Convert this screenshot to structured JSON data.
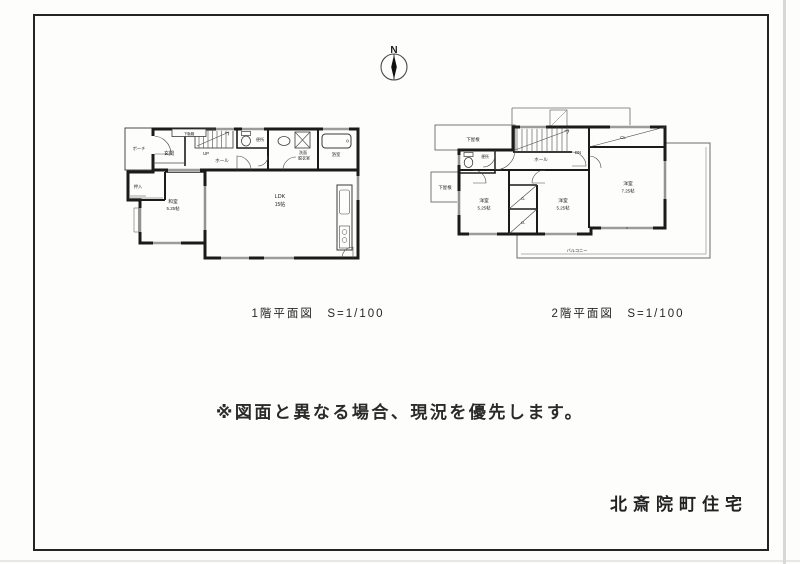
{
  "compass": {
    "label": "N"
  },
  "floor1": {
    "caption": "1階平面図　S=1/100",
    "labels": {
      "porch": "ポーチ",
      "entrance": "玄関",
      "shoe_cabinet": "下駄箱",
      "stairs": "UP",
      "hall": "ホール",
      "toilet": "便所",
      "washroom1": "洗面",
      "washroom2": "脱衣室",
      "bath": "浴室",
      "closet": "押入",
      "jroom_name": "和室",
      "jroom_size": "5.25帖",
      "ldk_name": "LDK",
      "ldk_size": "15帖"
    }
  },
  "floor2": {
    "caption": "2階平面図　S=1/100",
    "labels": {
      "roof_top": "下屋根",
      "roof_left": "下屋根",
      "toilet": "便所",
      "stairs": "DN",
      "hall": "ホール",
      "closet_top": "CL",
      "closet_a": "CL",
      "closet_b": "CL",
      "room1_name": "洋室",
      "room1_size": "5.25帖",
      "room2_name": "洋室",
      "room2_size": "5.25帖",
      "room3_name": "洋室",
      "room3_size": "7.25帖",
      "balcony": "バルコニー"
    }
  },
  "notice": "※図面と異なる場合、現況を優先します。",
  "title": "北斎院町住宅",
  "colors": {
    "line": "#1b1b1b",
    "thin": "#555555",
    "paper": "#fdfdfc"
  }
}
